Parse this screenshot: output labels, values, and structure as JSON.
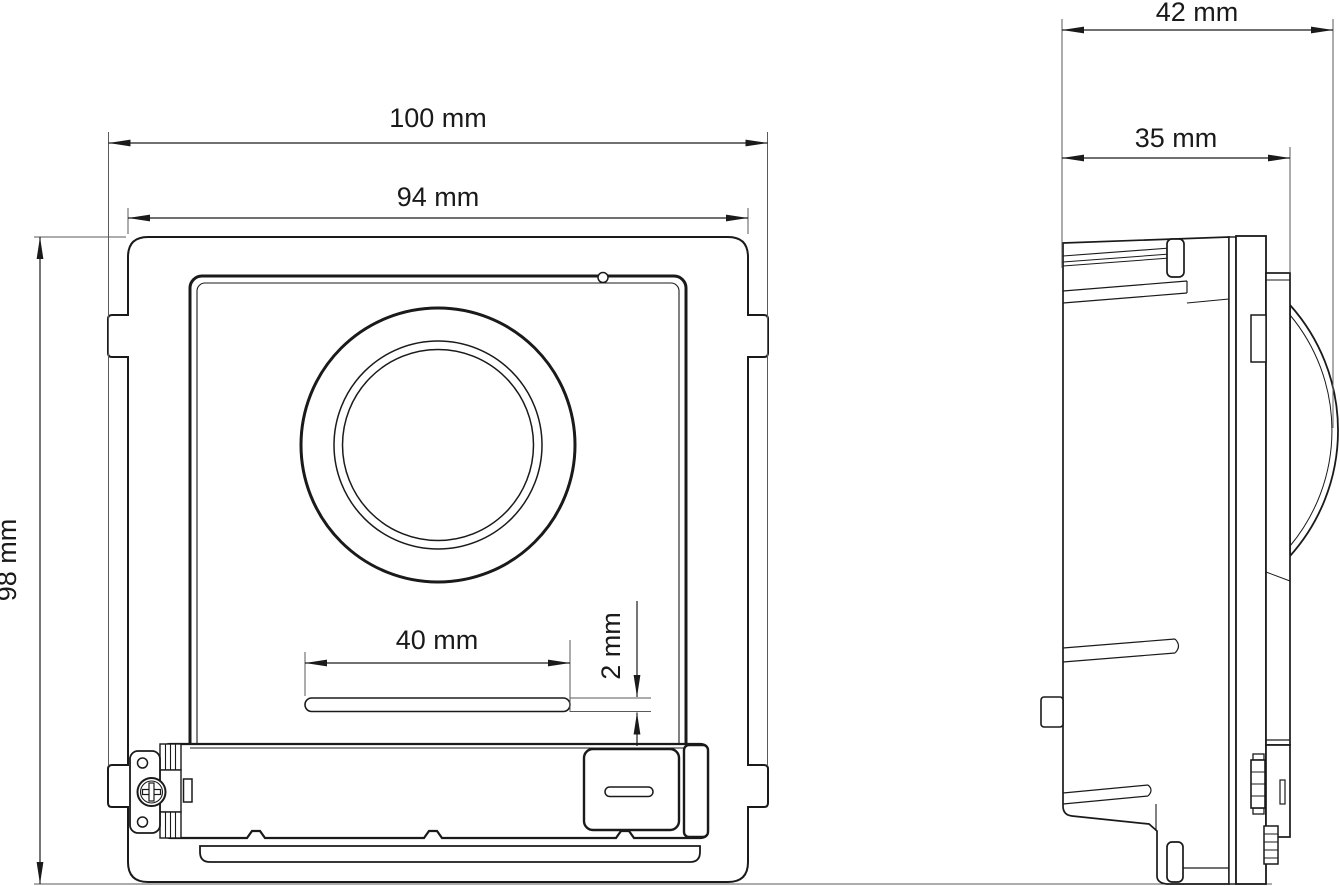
{
  "colors": {
    "background": "#ffffff",
    "line": "#1a1a1a"
  },
  "front_view": {
    "dim_overall_width": "100 mm",
    "dim_body_width": "94 mm",
    "dim_height": "98 mm",
    "dim_slot_width": "40 mm",
    "dim_slot_thickness": "2 mm"
  },
  "side_view": {
    "dim_overall_depth": "42 mm",
    "dim_body_depth": "35 mm"
  }
}
